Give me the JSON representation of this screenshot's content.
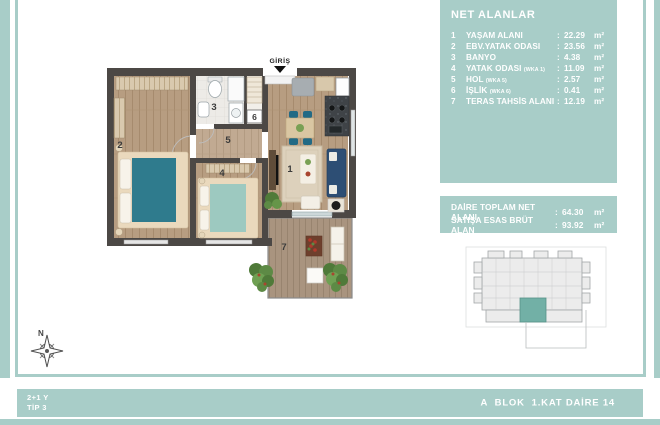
{
  "colors": {
    "accent_teal": "#a8cdc8",
    "unit_highlight": "#72b0a6"
  },
  "area_list": {
    "title": "NET ALANLAR",
    "separator": ":",
    "unit": "m²",
    "rows": [
      {
        "no": "1",
        "label": "YAŞAM ALANI",
        "sub": "",
        "value": "22.29"
      },
      {
        "no": "2",
        "label": "EBV.YATAK ODASI",
        "sub": "",
        "value": "23.56"
      },
      {
        "no": "3",
        "label": "BANYO",
        "sub": "",
        "value": "4.38"
      },
      {
        "no": "4",
        "label": "YATAK ODASI",
        "sub": "(WKA 1)",
        "value": "11.09"
      },
      {
        "no": "5",
        "label": "HOL",
        "sub": "(WKA 5)",
        "value": "2.57"
      },
      {
        "no": "6",
        "label": "İŞLİK",
        "sub": "(WKA 6)",
        "value": "0.41"
      },
      {
        "no": "7",
        "label": "TERAS TAHSİS ALANI",
        "sub": "",
        "value": "12.19"
      }
    ]
  },
  "totals": {
    "separator": ":",
    "unit": "m²",
    "rows": [
      {
        "label": "DAİRE TOPLAM NET ALANI",
        "value": "64.30"
      },
      {
        "label": "SATIŞA ESAS BRÜT ALAN",
        "value": "93.92"
      }
    ]
  },
  "floor_plan": {
    "entrance_label": "GİRİŞ",
    "rooms": {
      "living": "1",
      "master_bedroom": "2",
      "bathroom": "3",
      "bedroom": "4",
      "hall": "5",
      "utility": "6",
      "terrace": "7"
    }
  },
  "compass": {
    "north": "N"
  },
  "footer": {
    "plan_type_line1": "2+1 Y",
    "plan_type_line2": "TİP 3",
    "unit_location": "A  BLOK  1.KAT DAİRE 14"
  }
}
